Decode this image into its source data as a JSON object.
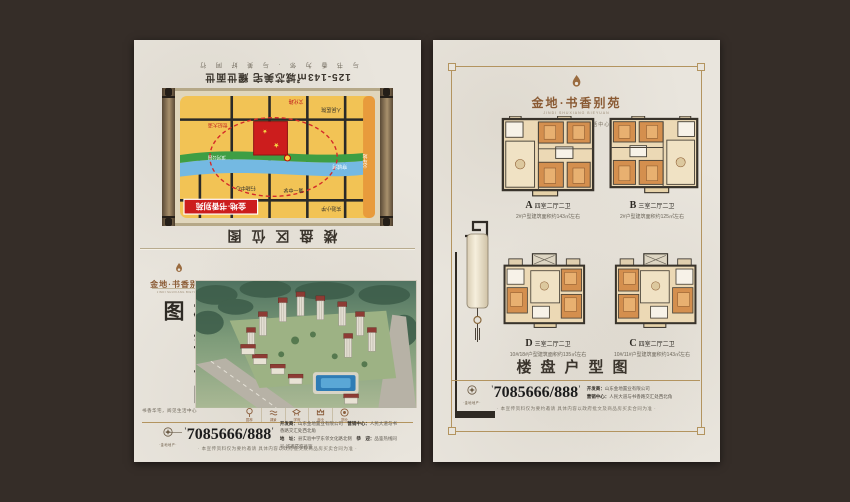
{
  "brand": {
    "name": "金地·书香别苑",
    "name_en": "JINDI SHUXIANG BIEYUAN",
    "tagline": "书香华宅 · 阅见生活中心"
  },
  "back_cover": {
    "slogan": "与 书 香 为 邻 · 与 美 好 同 行",
    "headline": "125-143㎡城芯美宅 耀世面世",
    "caption": "楼盘区位图",
    "map": {
      "project_label": "金地·书香别苑",
      "labels": [
        "实验小学",
        "第一中学",
        "行政中心",
        "人民医院",
        "世纪大道",
        "文化路",
        "穿城河",
        "滨河公园",
        "火车站"
      ]
    }
  },
  "front_cover": {
    "vertical_title": "楼盘鸟瞰图",
    "sub_tagline": "书香华宅，阅见生活中心",
    "amenities": [
      {
        "label": "园林"
      },
      {
        "label": "湖景"
      },
      {
        "label": "学府"
      },
      {
        "label": "商业"
      },
      {
        "label": "物业"
      }
    ]
  },
  "floorplans": {
    "title": "楼盘户型图",
    "plans": [
      {
        "letter": "A",
        "layout": "四室二厅二卫",
        "area": "2#户型建筑面积约143㎡左右"
      },
      {
        "letter": "B",
        "layout": "三室二厅二卫",
        "area": "2#户型建筑面积约125㎡左右"
      },
      {
        "letter": "D",
        "layout": "三室二厅二卫",
        "area": "10#/18#户型建筑面积约135㎡左右"
      },
      {
        "letter": "C",
        "layout": "四室二厅二卫",
        "area": "10#/11#户型建筑面积约143㎡左右"
      }
    ]
  },
  "footer": {
    "brand_small": "·金地地产·",
    "phone": "7085666/888",
    "info_lines": [
      [
        {
          "b": "开发商：",
          "t": "山东金地置业有限公司"
        },
        {
          "b": "营销中心：",
          "t": "人民大道与书香路交汇处西北角"
        }
      ],
      [
        {
          "b": "地　址：",
          "t": "县实验中学东邻文化路北侧"
        },
        {
          "b": "恭　迎：",
          "t": "品鉴热线同号 诚邀莅临品鉴"
        }
      ]
    ],
    "disclaimer": "· 本宣传资料仅为要约邀请 具体内容以政府批文及商品房买卖合同为准 ·"
  }
}
